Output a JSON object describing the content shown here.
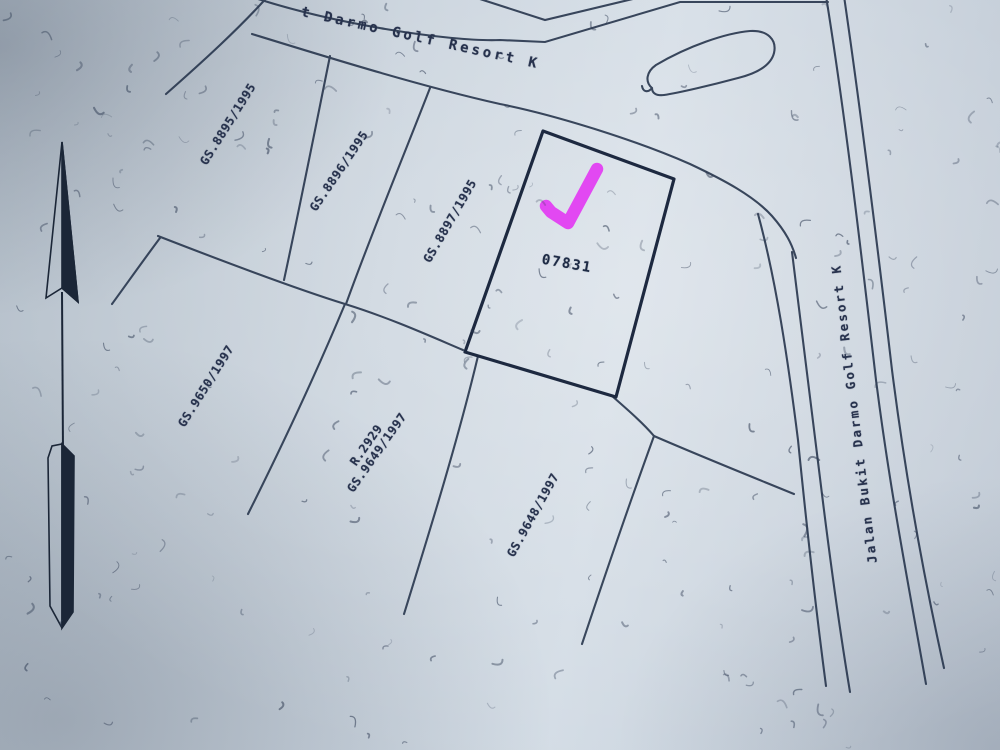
{
  "streets": {
    "top_label": "t Darmo Golf Resort K",
    "right_label": "Jalan Bukit Darmo Golf Resort K"
  },
  "parcels": {
    "upper": [
      "GS.8895/1995",
      "GS.8896/1995",
      "GS.8897/1995"
    ],
    "selected": {
      "id": "07831"
    },
    "lower_left": "GS.9650/1997",
    "lower_middle": [
      "R.2929",
      "GS.9649/1997"
    ],
    "lower_right": "GS.9648/1997"
  },
  "annotation": {
    "type": "checkmark",
    "color": "#e23cf2",
    "target_parcel": "07831"
  },
  "icons": [
    {
      "name": "north-arrow"
    },
    {
      "name": "checkmark-annotation"
    },
    {
      "name": "culdesac-island"
    }
  ],
  "colors": {
    "paper": "#c8d2dc",
    "ink": "#2b3950",
    "plot_outline": "#1d2940",
    "highlight": "#e23cf2"
  }
}
